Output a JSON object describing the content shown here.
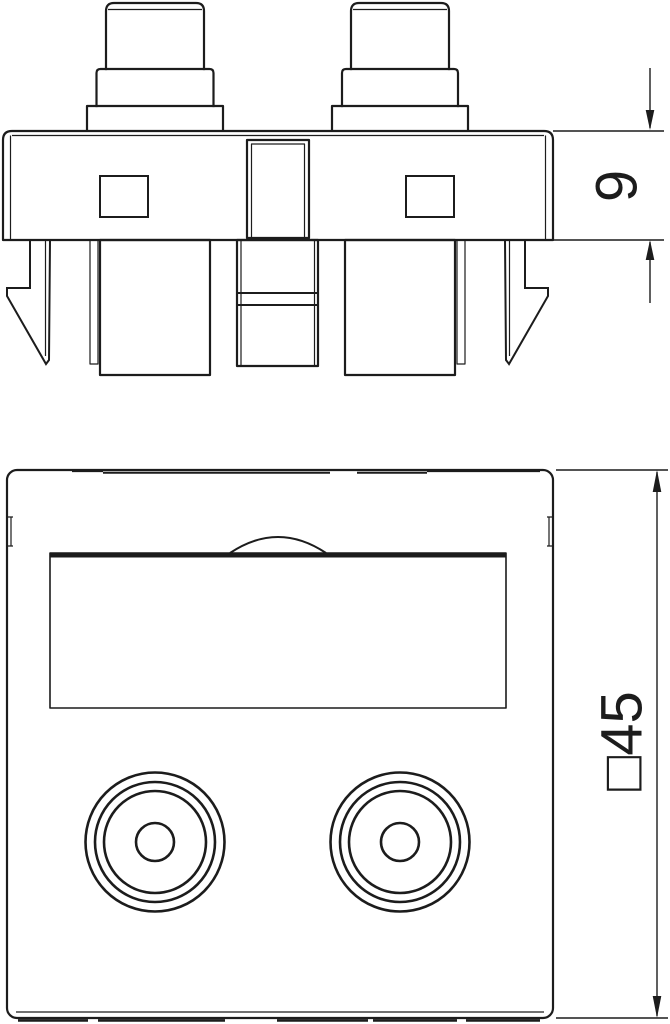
{
  "page": {
    "background": "#ffffff",
    "line_color": "#1c1c1c",
    "kind": "technical line drawing",
    "subject": "45x45 mount module with two cinch sockets, side view and front view"
  },
  "drawing": {
    "side_view": {
      "name": "side profile view with snap-in latches and two connector bushings",
      "dimension_label": "9"
    },
    "front_view": {
      "name": "front face view with labelling field and two round sockets",
      "dimension_label": "□45"
    }
  }
}
